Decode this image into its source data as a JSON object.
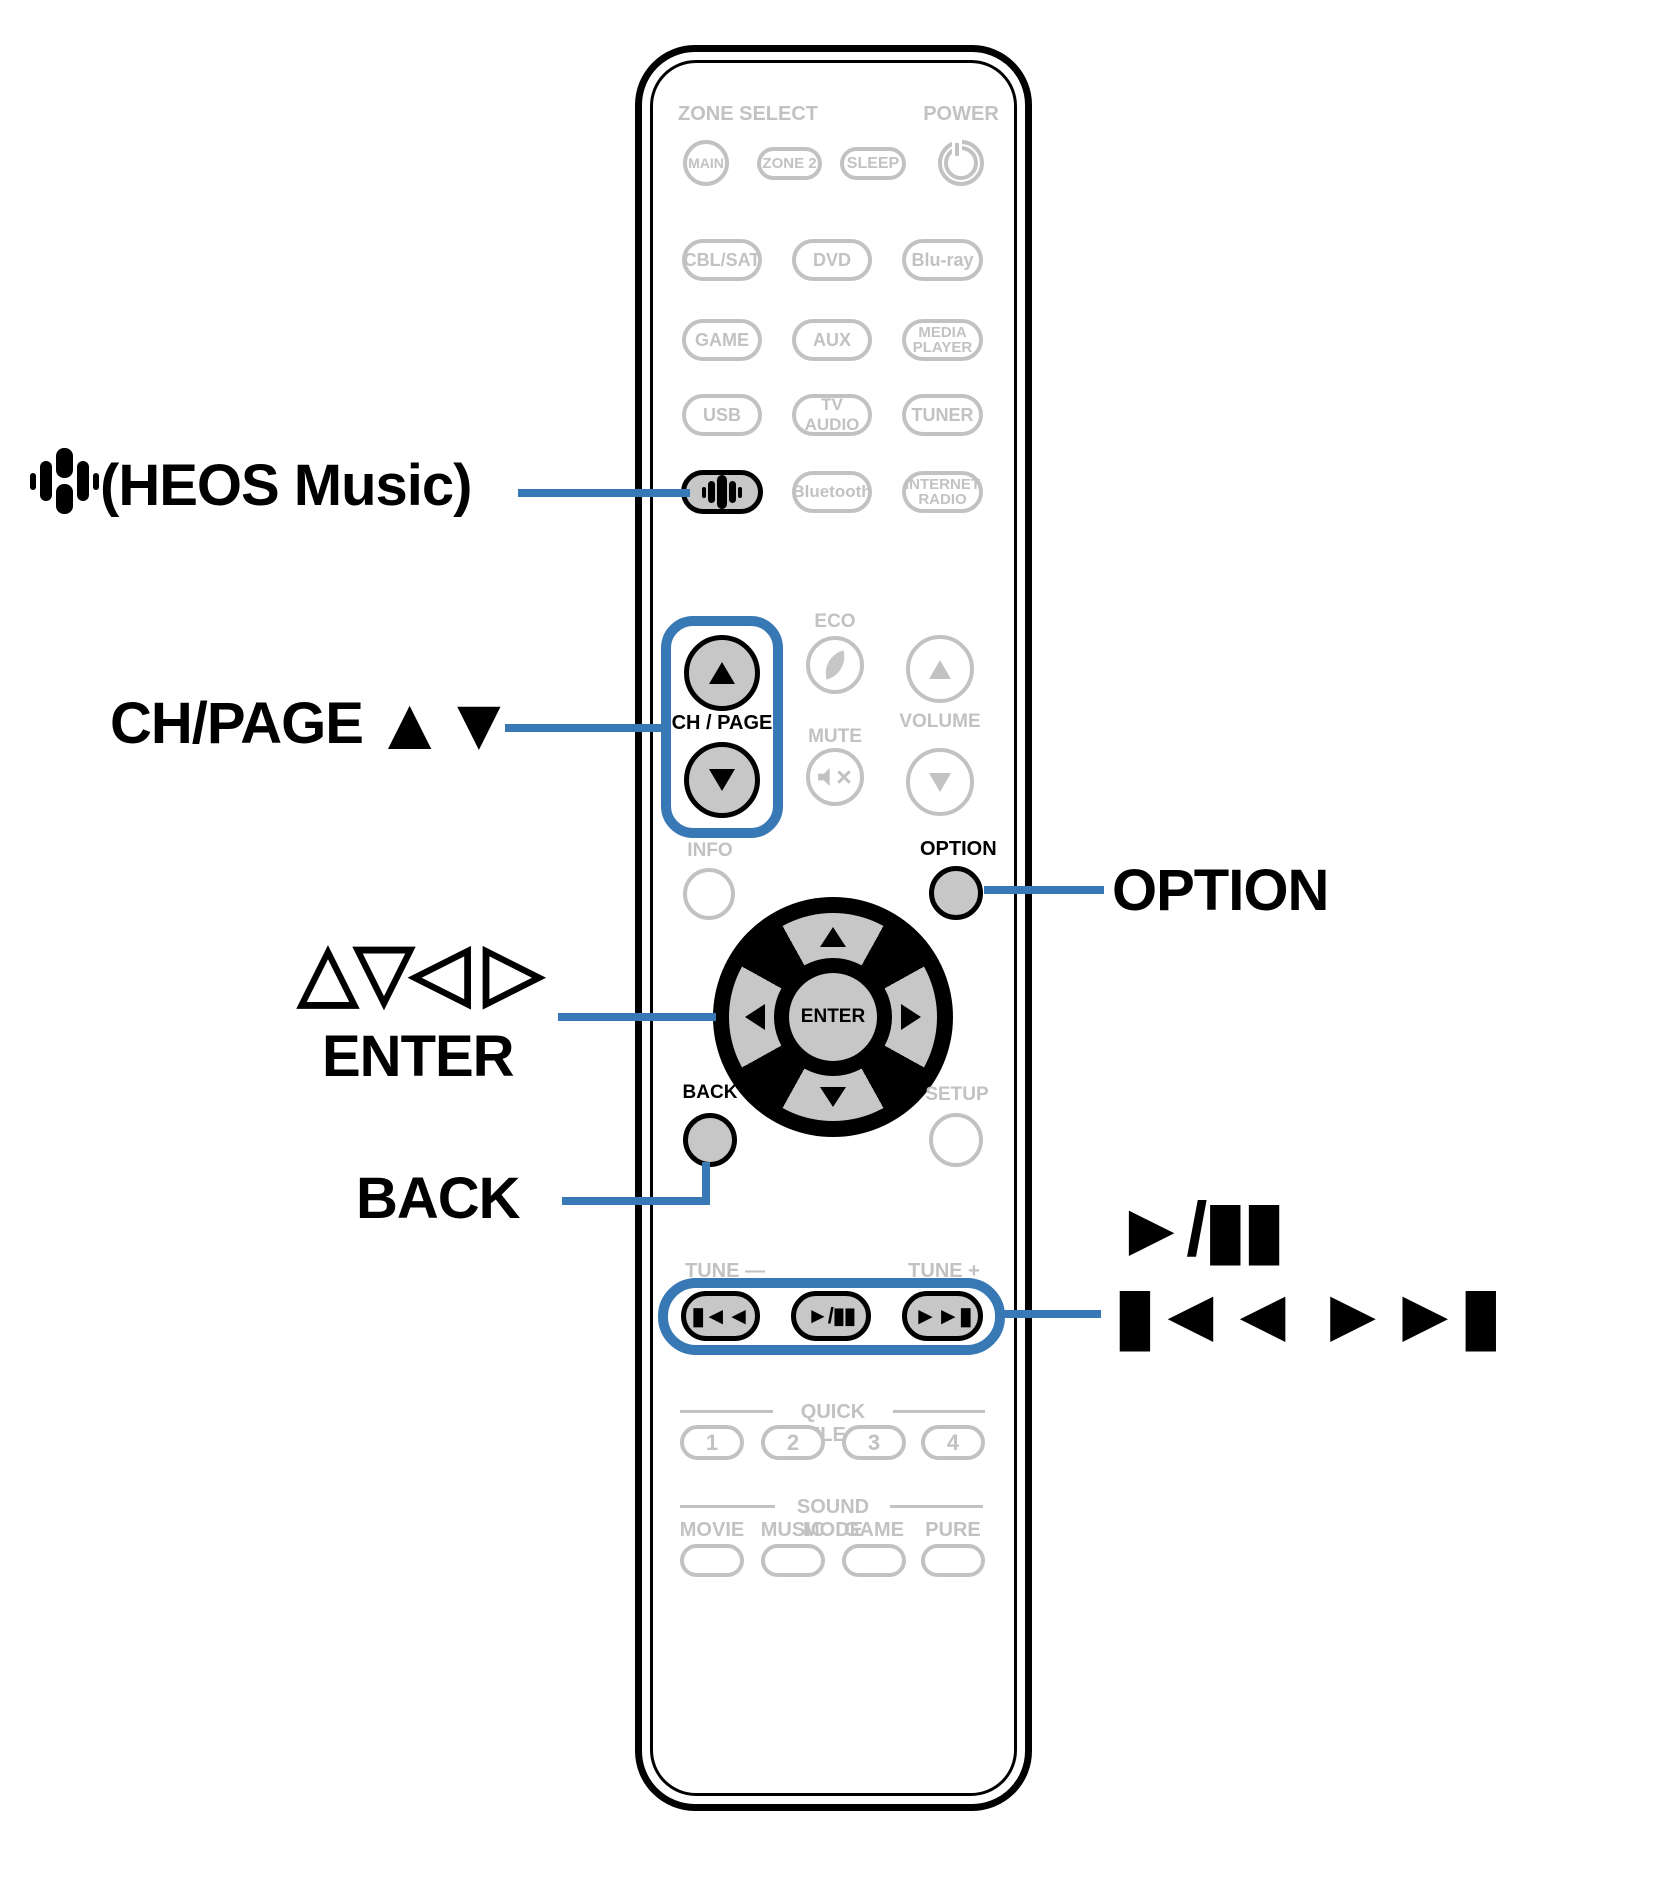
{
  "accent": "#3878b5",
  "callouts": {
    "heos": "(HEOS Music)",
    "ch_page": "CH/PAGE",
    "ch_page_arrows": "▲▼",
    "cursor": "△▽◁ ▷",
    "enter": "ENTER",
    "back": "BACK",
    "option": "OPTION",
    "play_pause": "►/▮▮",
    "skip": "▮◄◄ ►►▮"
  },
  "remote": {
    "zone_select": "ZONE SELECT",
    "power": "POWER",
    "main": "MAIN",
    "zone2": "ZONE 2",
    "sleep": "SLEEP",
    "cbl_sat": "CBL/SAT",
    "dvd": "DVD",
    "blu_ray": "Blu-ray",
    "game": "GAME",
    "aux": "AUX",
    "media_player": "MEDIA\nPLAYER",
    "usb": "USB",
    "tv_audio": "TV AUDIO",
    "tuner": "TUNER",
    "bluetooth": "Bluetooth",
    "internet_radio": "INTERNET\nRADIO",
    "eco": "ECO",
    "mute": "MUTE",
    "volume": "VOLUME",
    "ch_page": "CH / PAGE",
    "info": "INFO",
    "option": "OPTION",
    "enter": "ENTER",
    "back": "BACK",
    "setup": "SETUP",
    "tune_minus": "TUNE —",
    "tune_plus": "TUNE +",
    "quick_select": "QUICK SELECT",
    "q1": "1",
    "q2": "2",
    "q3": "3",
    "q4": "4",
    "sound_mode": "SOUND MODE",
    "movie": "MOVIE",
    "music": "MUSIC",
    "game_sm": "GAME",
    "pure": "PURE",
    "skip_back": "▮◄◄",
    "play_pause": "►/▮▮",
    "skip_fwd": "►►▮"
  }
}
